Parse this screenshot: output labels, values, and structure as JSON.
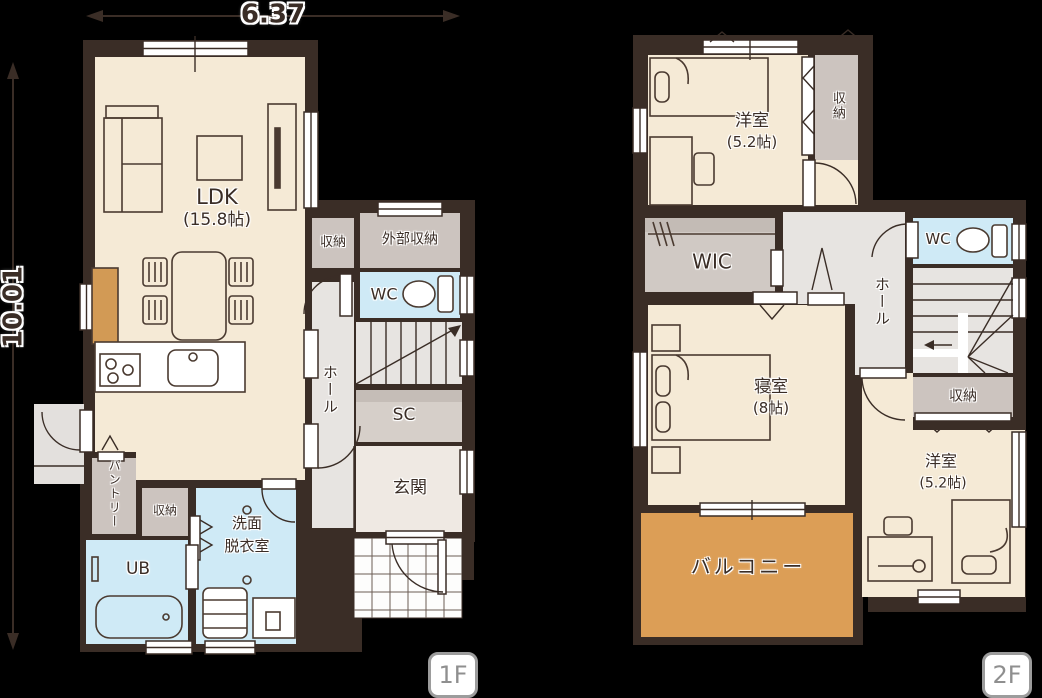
{
  "dimensions": {
    "width": "6.37",
    "height": "10.01"
  },
  "floor1": {
    "badge": "1F",
    "ldk_name": "LDK",
    "ldk_size": "(15.8帖)",
    "closet_mid": "収納",
    "exterior_storage": "外部収納",
    "wc": "WC",
    "hall": "ホール",
    "shoe_closet": "SC",
    "entrance": "玄関",
    "pantry": "パントリー",
    "closet_bottom": "収納",
    "washroom_line1": "洗面",
    "washroom_line2": "脱衣室",
    "unit_bath": "UB"
  },
  "floor2": {
    "badge": "2F",
    "bedroom_top_name": "洋室",
    "bedroom_top_size": "(5.2帖)",
    "closet_top": "収納",
    "wic": "WIC",
    "wc": "WC",
    "hall": "ホール",
    "master_name": "寝室",
    "master_size": "(8帖)",
    "closet_right": "収納",
    "bedroom_bottom_name": "洋室",
    "bedroom_bottom_size": "(5.2帖)",
    "balcony": "バルコニー"
  },
  "colors": {
    "wall": "#3a2d26",
    "room_cream": "#f5ead6",
    "hall_gray": "#e7e4e1",
    "closet_gray": "#ccc4bf",
    "wet_blue": "#cfeaf6",
    "balcony_orange": "#dc9e56",
    "badge_gray": "#9c9c9c"
  }
}
